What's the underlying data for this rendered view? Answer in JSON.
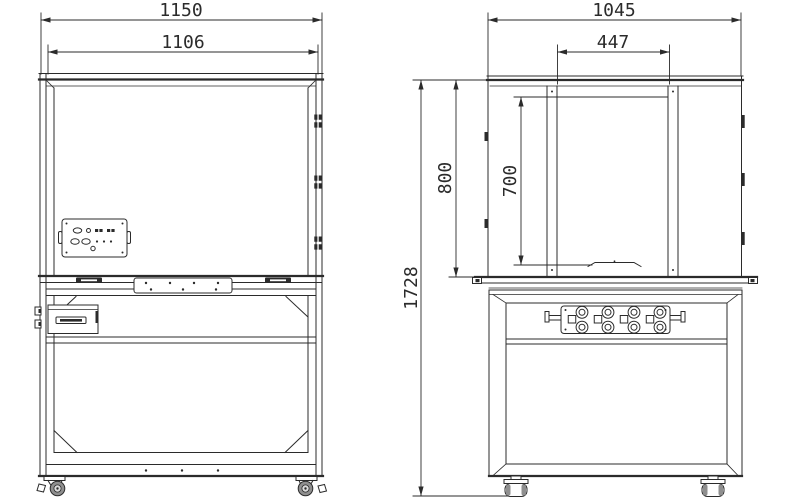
{
  "drawing_type": "two-view engineering drawing of a wheeled workbench cabinet",
  "colors": {
    "line": "#2b2b2b",
    "background": "#ffffff"
  },
  "views": {
    "front": {
      "dimensions": {
        "overall_width": "1150",
        "opening_width": "1106"
      }
    },
    "side": {
      "dimensions": {
        "overall_depth": "1045",
        "opening_depth": "447",
        "upper_section_height": "800",
        "opening_height": "700",
        "overall_height": "1728"
      }
    }
  }
}
